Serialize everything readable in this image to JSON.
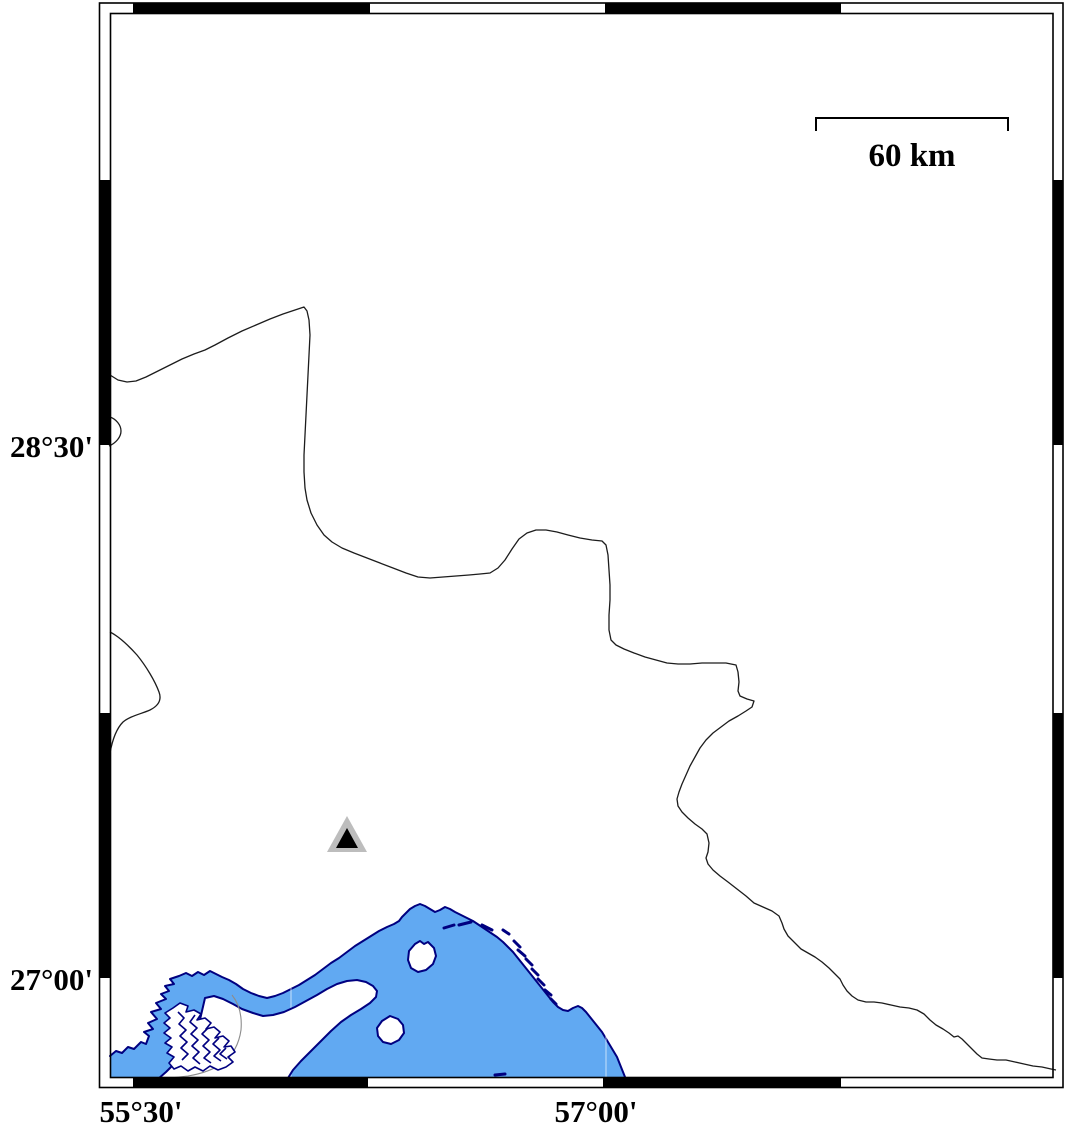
{
  "map": {
    "labels": {
      "lat_upper": "28°30'",
      "lat_lower": "27°00'",
      "lon_left": "55°30'",
      "lon_right": "57°00'"
    },
    "scale_bar": {
      "label": "60 km"
    },
    "marker": {
      "symbol": "triangle"
    },
    "colors": {
      "sea": "#61a9f2",
      "coastline": "#000080",
      "boundary": "#1c1c1c",
      "tidal_outline": "#8c8c8c",
      "marker_halo": "#bdbdbd",
      "marker_core": "#000000",
      "frame": "#000000"
    }
  }
}
